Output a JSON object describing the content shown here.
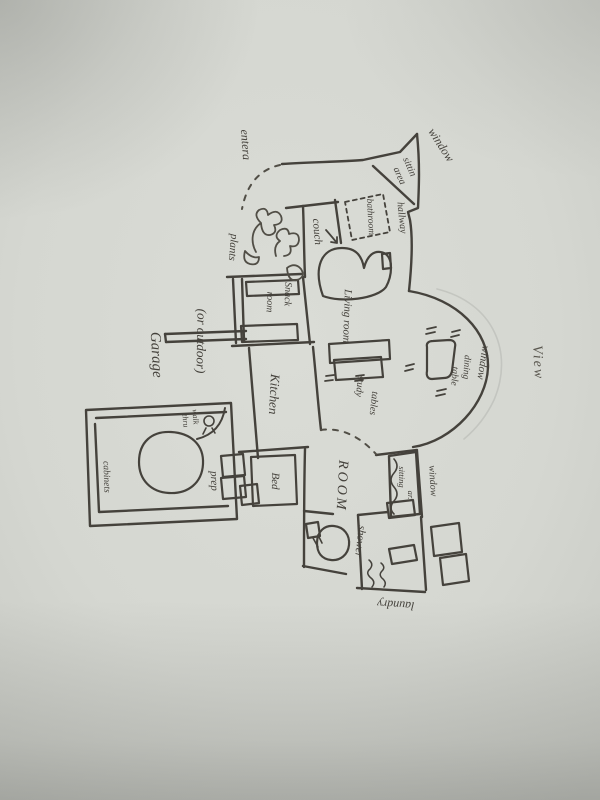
{
  "colors": {
    "paper": "#d7d9d3",
    "paper_edge": "#c6c8c2",
    "ink": "#45423c",
    "shadow": "#3c3e3a"
  },
  "labels": {
    "entrance": "entera",
    "window_top": "window",
    "sitting_nook_1": "sittin",
    "sitting_nook_2": "area",
    "hallway": "hallway",
    "bathroom": "bathroom",
    "couch": "couch",
    "living_room": "Living room",
    "study_1": "study",
    "study_2": "tables",
    "dining_1": "dining",
    "dining_2": "table",
    "window_bay": "window",
    "view": "View",
    "plants": "plants",
    "snack_1": "Snack",
    "snack_2": "room",
    "garage": "Garage",
    "garage_note": "(or outdoor)",
    "kitchen": "Kitchen",
    "cabinets": "cabinets",
    "walkthru_1": "walk",
    "walkthru_2": "thru",
    "prep": "prep",
    "bed": "Bed",
    "room": "ROOM",
    "sitting_small_1": "sitting",
    "sitting_small_2": "ar.",
    "window_right": "window",
    "shower": "shower",
    "laundry": "laundry"
  }
}
